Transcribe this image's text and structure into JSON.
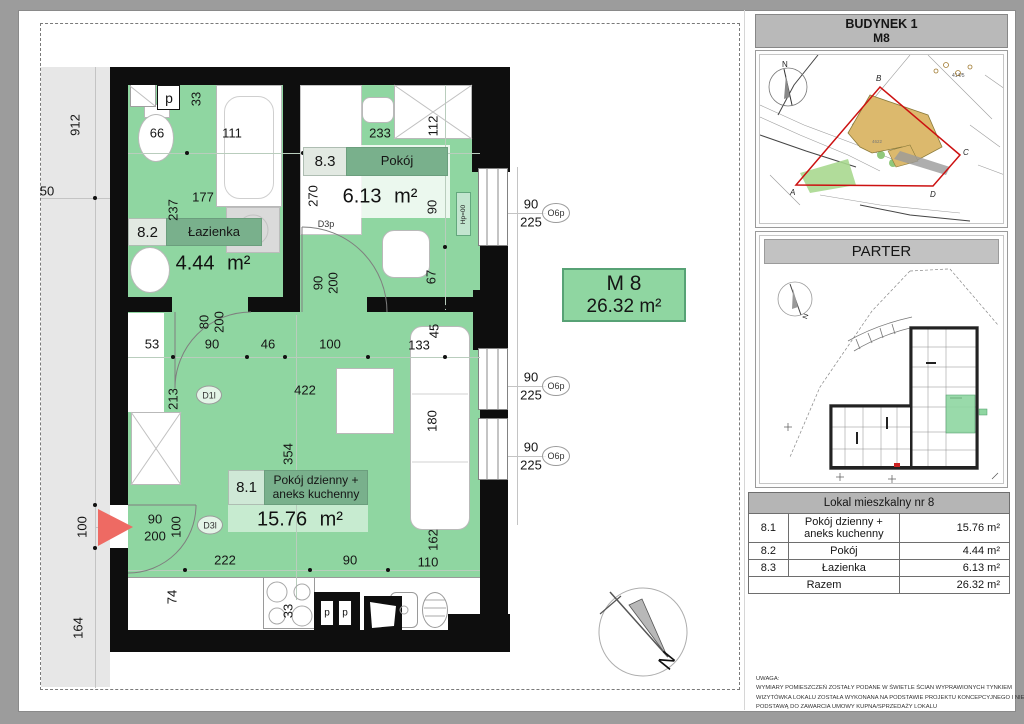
{
  "plan": {
    "unit_box": {
      "name": "M 8",
      "area": "26.32 m²"
    },
    "rooms": {
      "r82": {
        "id": "8.2",
        "name": "Łazienka",
        "area": "4.44 m²"
      },
      "r83": {
        "id": "8.3",
        "name": "Pokój",
        "area": "6.13 m²"
      },
      "r81": {
        "id": "8.1",
        "name": "Pokój dzienny + aneks kuchenny",
        "area": "15.76 m²"
      }
    },
    "window_sill_label": "Hp=00",
    "compass_label": "N",
    "dimensions": [
      {
        "t": "912",
        "x": 75,
        "y": 125,
        "r": -90
      },
      {
        "t": "50",
        "x": 47,
        "y": 191
      },
      {
        "t": "100",
        "x": 82,
        "y": 527,
        "r": -90
      },
      {
        "t": "164",
        "x": 78,
        "y": 628,
        "r": -90
      },
      {
        "t": "66",
        "x": 157,
        "y": 133
      },
      {
        "t": "111",
        "x": 232,
        "y": 133
      },
      {
        "t": "233",
        "x": 380,
        "y": 133
      },
      {
        "t": "112",
        "x": 433,
        "y": 126,
        "r": -90
      },
      {
        "t": "33",
        "x": 196,
        "y": 99,
        "r": -90
      },
      {
        "t": "177",
        "x": 203,
        "y": 197
      },
      {
        "t": "237",
        "x": 173,
        "y": 210,
        "r": -90
      },
      {
        "t": "270",
        "x": 313,
        "y": 196,
        "r": -90
      },
      {
        "t": "90",
        "x": 432,
        "y": 207,
        "r": -90
      },
      {
        "t": "67",
        "x": 431,
        "y": 277,
        "r": -90
      },
      {
        "t": "90",
        "x": 318,
        "y": 283,
        "r": -90
      },
      {
        "t": "200",
        "x": 333,
        "y": 283,
        "r": -90
      },
      {
        "t": "80",
        "x": 204,
        "y": 322,
        "r": -90
      },
      {
        "t": "200",
        "x": 219,
        "y": 322,
        "r": -90
      },
      {
        "t": "53",
        "x": 152,
        "y": 344
      },
      {
        "t": "90",
        "x": 212,
        "y": 344
      },
      {
        "t": "46",
        "x": 268,
        "y": 344
      },
      {
        "t": "100",
        "x": 330,
        "y": 344
      },
      {
        "t": "133",
        "x": 419,
        "y": 345
      },
      {
        "t": "45",
        "x": 434,
        "y": 331,
        "r": -90
      },
      {
        "t": "422",
        "x": 305,
        "y": 390
      },
      {
        "t": "213",
        "x": 173,
        "y": 399,
        "r": -90
      },
      {
        "t": "180",
        "x": 432,
        "y": 421,
        "r": -90
      },
      {
        "t": "354",
        "x": 288,
        "y": 454,
        "r": -90
      },
      {
        "t": "90",
        "x": 155,
        "y": 519
      },
      {
        "t": "200",
        "x": 155,
        "y": 536
      },
      {
        "t": "100",
        "x": 176,
        "y": 527,
        "r": -90
      },
      {
        "t": "222",
        "x": 225,
        "y": 560
      },
      {
        "t": "90",
        "x": 350,
        "y": 560
      },
      {
        "t": "110",
        "x": 428,
        "y": 562
      },
      {
        "t": "162",
        "x": 433,
        "y": 540,
        "r": -90
      },
      {
        "t": "74",
        "x": 172,
        "y": 597,
        "r": -90
      },
      {
        "t": "33",
        "x": 288,
        "y": 611,
        "r": -90
      }
    ],
    "windows": [
      {
        "width": "90",
        "height": "225",
        "symbol": "O6p",
        "x": 531,
        "y1": 204,
        "y2": 222,
        "cx": 556,
        "cy": 213
      },
      {
        "width": "90",
        "height": "225",
        "symbol": "O6p",
        "x": 531,
        "y1": 377,
        "y2": 395,
        "cx": 556,
        "cy": 386
      },
      {
        "width": "90",
        "height": "225",
        "symbol": "O6p",
        "x": 531,
        "y1": 447,
        "y2": 465,
        "cx": 556,
        "cy": 456
      }
    ],
    "doors": [
      {
        "label": "D1l",
        "x": 209,
        "y": 395,
        "circled": true
      },
      {
        "label": "D3l",
        "x": 210,
        "y": 525,
        "circled": true
      },
      {
        "label": "D3p",
        "x": 326,
        "y": 224,
        "circled": false
      }
    ],
    "fixtures": [
      {
        "label": "p",
        "x": 169,
        "y": 98,
        "size": 14
      },
      {
        "label": "p",
        "x": 327,
        "y": 613,
        "size": 10
      },
      {
        "label": "p",
        "x": 345,
        "y": 613,
        "size": 10
      }
    ]
  },
  "sidebar": {
    "building_header": {
      "line1": "BUDYNEK 1",
      "line2": "M8"
    },
    "map": {
      "parcel_label": "414/5",
      "building_label": "4622",
      "corners": {
        "a": "A",
        "b": "B",
        "c": "C",
        "d": "D"
      },
      "north": "N"
    },
    "floor_header": "PARTER",
    "parter_north": "N",
    "table": {
      "header": "Lokal mieszkalny nr 8",
      "rows": [
        {
          "id": "8.1",
          "name": "Pokój dzienny + aneks kuchenny",
          "area": "15.76 m²"
        },
        {
          "id": "8.2",
          "name": "Pokój",
          "area": "4.44 m²"
        },
        {
          "id": "8.3",
          "name": "Łazienka",
          "area": "6.13 m²"
        }
      ],
      "total_label": "Razem",
      "total_area": "26.32 m²"
    },
    "notes": [
      "UWAGA:",
      "WYMIARY POMIESZCZEŃ ZOSTAŁY PODANE W ŚWIETLE ŚCIAN WYPRAWIONYCH TYNKIEM",
      "WIZYTÓWKA LOKALU ZOSTAŁA WYKONANA NA PODSTAWIE PROJEKTU KONCEPCYJNEGO I NIE JEST",
      "PODSTAWĄ DO ZAWARCIA UMOWY KUPNA/SPRZEDAŻY LOKALU"
    ]
  },
  "colors": {
    "plan_green": "#8fd6a1",
    "label_green": "#79b08c",
    "wall": "#0e0e0e",
    "entry_arrow": "#ee6a63",
    "map_building_tan": "#dcb96d",
    "map_green": "#a8d88f",
    "boundary_red": "#cc1111"
  }
}
